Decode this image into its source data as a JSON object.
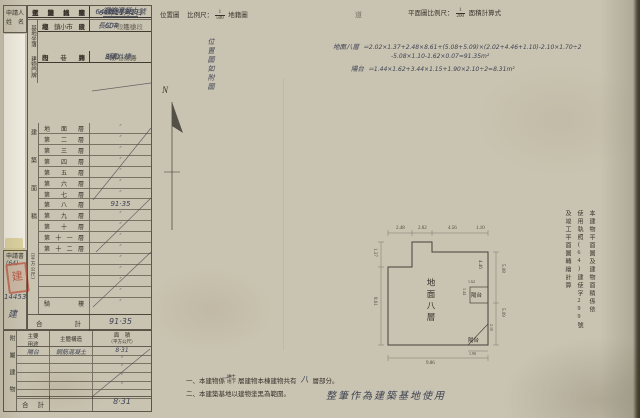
{
  "header": {
    "location_map_label": "位置圖",
    "location_scale_label": "比例尺：",
    "location_scale_num": "1",
    "location_scale_den": "500",
    "location_suffix": "地籍圖",
    "stray_char": "道",
    "plan_scale_label": "平面圖比例尺：",
    "plan_scale_num": "1",
    "plan_scale_den": "200",
    "plan_scale_suffix": "面積計算式"
  },
  "compass_label": "N",
  "location_note": "位置圖如附圖",
  "applicant_box": {
    "l1": "申請人",
    "l2": "姓　名"
  },
  "doc_box": {
    "title": "申請書",
    "pref": "(64)",
    "seal": "建",
    "num": "14453",
    "char": "建"
  },
  "main": {
    "survey": {
      "label": "測量日期",
      "value": "64年11月1日"
    },
    "site": {
      "glabel": "基地坐落",
      "rows": [
        {
          "label": "鄉鎮市區",
          "hand": "中",
          "suffix": "區"
        },
        {
          "label": "段小段",
          "hand": "長江",
          "suffix": "段　小段"
        },
        {
          "label": "地號",
          "hand": "604",
          "suffix": "地號"
        }
      ]
    },
    "addr": {
      "glabel": "建物門牌",
      "rows": [
        {
          "label": "街路",
          "hand": "湖和",
          "suffix": "街路"
        },
        {
          "label": "段巷弄",
          "hand": "",
          "suffix": "段/巷　弄"
        },
        {
          "label": "門牌",
          "hand": "8號八樓",
          "suffix": ""
        }
      ]
    },
    "info_rows": [
      {
        "label": "建築式樣",
        "hand": ""
      },
      {
        "label": "主體構造",
        "hand": "鋼筋混凝土",
        "cls": "ul"
      },
      {
        "label": "主要用途",
        "hand": "集合住宅",
        "cls": "faint"
      },
      {
        "label": "使用執照",
        "hand": "64建使字299號"
      }
    ],
    "floor": {
      "glabel": "建築面積",
      "unit": "（平方公尺）",
      "rows": [
        {
          "label": "地面層",
          "v": "″"
        },
        {
          "label": "第二層",
          "v": "″"
        },
        {
          "label": "第三層",
          "v": "″"
        },
        {
          "label": "第四層",
          "v": "″"
        },
        {
          "label": "第五層",
          "v": "″"
        },
        {
          "label": "第六層",
          "v": "″"
        },
        {
          "label": "第七層",
          "v": "″"
        },
        {
          "label": "第八層",
          "v": "91·35",
          "cls": "big"
        },
        {
          "label": "第九層",
          "v": "″"
        },
        {
          "label": "第十層",
          "v": "″"
        },
        {
          "label": "第十一層",
          "v": "″"
        },
        {
          "label": "第十二層",
          "v": "″"
        },
        {
          "label": "",
          "v": "″"
        },
        {
          "label": "",
          "v": "″"
        },
        {
          "label": "",
          "v": "″"
        },
        {
          "label": "",
          "v": "″"
        },
        {
          "label": "騎樓",
          "v": "″",
          "cls": "tall"
        }
      ],
      "total_label": "合計",
      "total": "91·35"
    },
    "annex": {
      "glabel": "附屬建物",
      "h_use1": "主要",
      "h_use2": "用途",
      "h_struct": "主體構造",
      "h_area1": "面　積",
      "h_area2": "（平方公尺）",
      "rows": [
        {
          "use": "陽台",
          "st": "鋼筋混凝土",
          "a": "8·31"
        },
        {
          "use": "",
          "st": "",
          "a": "″"
        },
        {
          "use": "",
          "st": "",
          "a": "″"
        },
        {
          "use": "",
          "st": "",
          "a": "″"
        },
        {
          "use": "",
          "st": "",
          "a": "″"
        },
        {
          "use": "",
          "st": "",
          "a": ""
        }
      ],
      "total_label": "合計",
      "total": "8·31"
    }
  },
  "calc": {
    "l1_label": "地面八層",
    "l1": "＝2.02×1.37+2.48×8.61+(5.08+5.09)×(2.02+4.46+1.10)-2.10×1.70÷2",
    "l2": "-5.08×1.10-1.62×0.07=91.35m²",
    "l3_label": "陽台",
    "l3": "＝1.44×1.62+3.44×1.15+1.90×2.10÷2=8.31m²"
  },
  "plan": {
    "interior": "地面八層",
    "balcony1": "陽台",
    "balcony2": "陽台",
    "dims": {
      "t1": "2.48",
      "t2": "2.02",
      "t3": "4.56",
      "t4": "1.10",
      "l1": "1.37",
      "l2": "8.61",
      "r1": "4.46",
      "r2": "5.08",
      "r3": "5.09",
      "b1": "1.62",
      "b2": "1.44",
      "tr1": "2.10",
      "tr2": "1.90",
      "bottom": "9.86"
    }
  },
  "side_note": {
    "c1": "本建物平面圖及建物面積係依",
    "c2": "使用執照(64)建使字299號",
    "c3": "及竣工平面圖轉繪計算"
  },
  "notes": {
    "n1a": "一、本建物係",
    "stack_top": "地上",
    "stack_bot": "地下",
    "n1b": "層建物本棟建物共有",
    "hand": "八",
    "n1c": "層部分。",
    "n2": "二、本建築基地以建物塗黑為範圍。",
    "big": "整筆作為建築基地使用"
  }
}
